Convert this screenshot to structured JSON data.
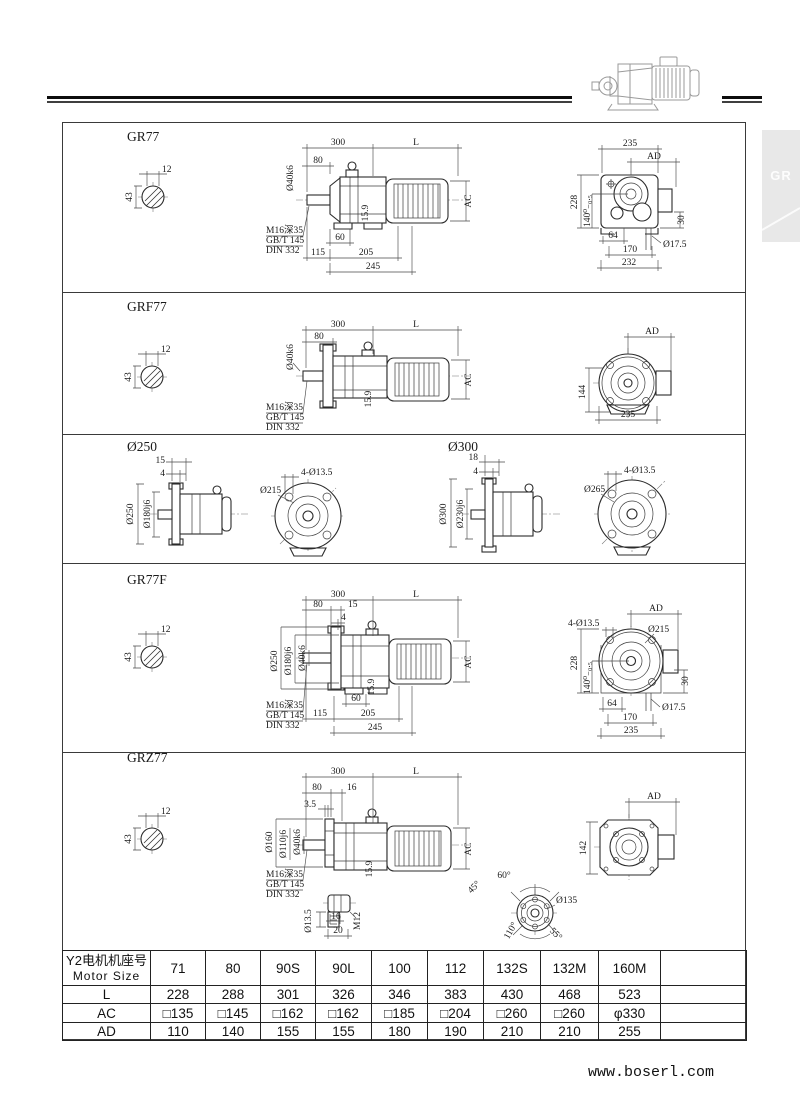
{
  "page": {
    "tab_label": "GR",
    "website": "www.boserl.com",
    "colors": {
      "ink": "#1a1a1a",
      "tab_bg": "#e8e8e8",
      "rule": "#0d0d0d"
    }
  },
  "sections": {
    "gr77": {
      "title": "GR77",
      "shaft": {
        "width": "12",
        "diameter": "43"
      },
      "side": {
        "len300": "300",
        "lenL": "L",
        "d80": "80",
        "shaft_fit": "Ø40k6",
        "note1": "M16深35",
        "note2": "GB/T 145",
        "note3": "DIN 332",
        "key": "15.9",
        "d60": "60",
        "d115": "115",
        "d205": "205",
        "d245": "245",
        "ac": "AC"
      },
      "end": {
        "d235": "235",
        "ad": "AD",
        "d228": "228",
        "tol140": "140⁰₋₀.₅",
        "d30": "30",
        "d64": "64",
        "d170": "170",
        "d232": "232",
        "hole": "Ø17.5"
      }
    },
    "grf77": {
      "title": "GRF77",
      "shaft": {
        "width": "12",
        "diameter": "43"
      },
      "side": {
        "len300": "300",
        "lenL": "L",
        "d80": "80",
        "shaft_fit": "Ø40k6",
        "note1": "M16深35",
        "note2": "GB/T 145",
        "note3": "DIN 332",
        "key": "15.9",
        "ac": "AC"
      },
      "end": {
        "ad": "AD",
        "d144": "144",
        "d235": "235"
      }
    },
    "flange250": {
      "title": "Ø250",
      "side": {
        "d15": "15",
        "d4": "4",
        "outer": "Ø250",
        "spigot": "Ø180j6"
      },
      "front": {
        "bolt_circle": "Ø215",
        "holes": "4-Ø13.5"
      }
    },
    "flange300": {
      "title": "Ø300",
      "side": {
        "d18": "18",
        "d4": "4",
        "outer": "Ø300",
        "spigot": "Ø230j6"
      },
      "front": {
        "bolt_circle": "Ø265",
        "holes": "4-Ø13.5"
      }
    },
    "gr77f": {
      "title": "GR77F",
      "shaft": {
        "width": "12",
        "diameter": "43"
      },
      "side": {
        "len300": "300",
        "lenL": "L",
        "d80": "80",
        "d15": "15",
        "d4": "4",
        "outer": "Ø250",
        "spigot": "Ø180j6",
        "shaft_fit": "Ø40k6",
        "note1": "M16深35",
        "note2": "GB/T 145",
        "note3": "DIN 332",
        "key": "15.9",
        "d60": "60",
        "d115": "115",
        "d205": "205",
        "d245": "245",
        "ac": "AC"
      },
      "end": {
        "ad": "AD",
        "holes": "4-Ø13.5",
        "bolt_circle": "Ø215",
        "d228": "228",
        "tol140": "140⁰₋₀.₅",
        "d30": "30",
        "d64": "64",
        "d170": "170",
        "d235": "235",
        "hole": "Ø17.5"
      }
    },
    "grz77": {
      "title": "GRZ77",
      "shaft": {
        "width": "12",
        "diameter": "43"
      },
      "side": {
        "len300": "300",
        "lenL": "L",
        "d80": "80",
        "d16": "16",
        "d35": "3.5",
        "hollow": "Ø160",
        "spigot": "Ø110j6",
        "shaft_fit": "Ø40k6",
        "note1": "M16深35",
        "note2": "GB/T 145",
        "note3": "DIN 332",
        "key": "15.9",
        "ac": "AC"
      },
      "end": {
        "ad": "AD",
        "d142": "142"
      },
      "detail": {
        "hole": "Ø13.5",
        "d16": "16",
        "d20": "20",
        "thread": "M12"
      },
      "bolt_view": {
        "a60": "60°",
        "a45": "45°",
        "a110": "110°",
        "a55": "55°",
        "dia": "Ø135"
      }
    }
  },
  "table": {
    "header_line1": "Y2电机机座号",
    "header_line2": "Motor Size",
    "cols": [
      "71",
      "80",
      "90S",
      "90L",
      "100",
      "112",
      "132S",
      "132M",
      "160M"
    ],
    "rows": [
      {
        "label": "L",
        "values": [
          "228",
          "288",
          "301",
          "326",
          "346",
          "383",
          "430",
          "468",
          "523"
        ]
      },
      {
        "label": "AC",
        "values": [
          "□135",
          "□145",
          "□162",
          "□162",
          "□185",
          "□204",
          "□260",
          "□260",
          "φ330"
        ]
      },
      {
        "label": "AD",
        "values": [
          "110",
          "140",
          "155",
          "155",
          "180",
          "190",
          "210",
          "210",
          "255"
        ]
      }
    ]
  }
}
